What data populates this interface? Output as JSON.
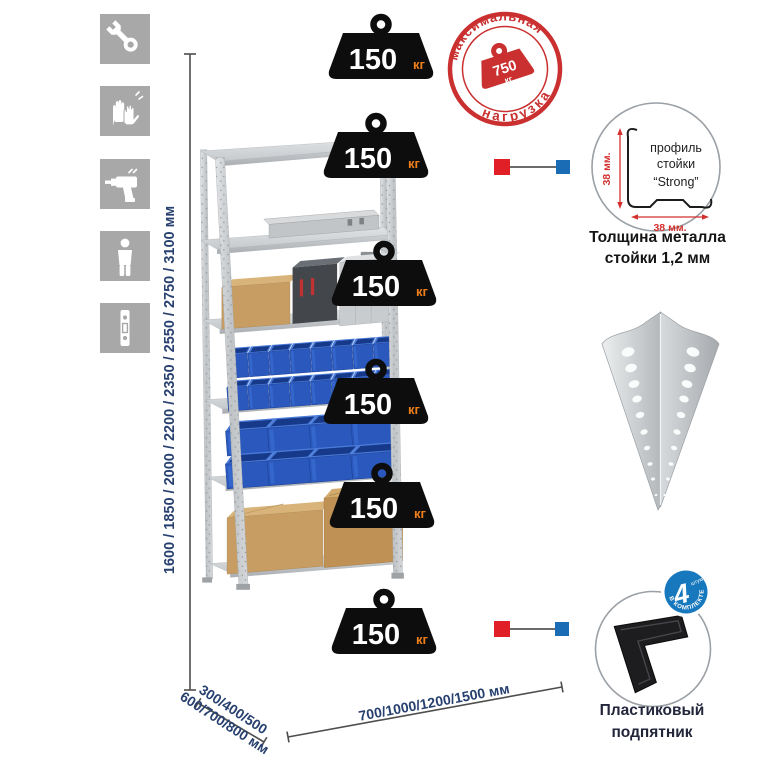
{
  "title": "Металлический стеллаж — инфографика",
  "sidebar": {
    "icons": [
      {
        "name": "wrench-icon"
      },
      {
        "name": "gloves-icon"
      },
      {
        "name": "drill-icon"
      },
      {
        "name": "person-height-icon"
      },
      {
        "name": "rack-post-icon"
      }
    ]
  },
  "shelf_load": {
    "value": "150",
    "unit": "кг",
    "shelves_count": 6
  },
  "max_load_stamp": {
    "arc_top": "максимальная",
    "arc_bottom": "нагрузка",
    "weight_value": "750",
    "weight_unit": "кг",
    "color": "#c9302f"
  },
  "dimensions": {
    "height_label": "1600 / 1850 / 2000 / 2200 / 2350 / 2550 / 2750 / 3100 мм",
    "depth_label_line1": "300/400/500",
    "depth_label_line2": "600/700/800 мм",
    "width_label": "700/1000/1200/1500 мм",
    "text_color": "#27406f"
  },
  "profile_detail": {
    "line1": "профиль",
    "line2": "стойки",
    "line3": "“Strong”",
    "dim_vertical": "38 мм.",
    "dim_horizontal": "38 мм.",
    "caption_line1": "Толщина металла",
    "caption_line2": "стойки 1,2 мм"
  },
  "foot_detail": {
    "caption_line1": "Пластиковый",
    "caption_line2": "подпятник",
    "badge": {
      "count": "4",
      "count_unit": "штуки",
      "arc_text": "в комплекте",
      "color": "#1878bd"
    }
  },
  "colors": {
    "accent_red": "#e01f26",
    "accent_blue": "#1a6cb5",
    "stamp_red": "#c9302f",
    "navy_text": "#27406f",
    "metal_gray": "#cfd2d5",
    "bin_blue": "#2a58bd",
    "box_tan": "#c79d63",
    "icon_tile_gray": "#a8a8a8"
  }
}
